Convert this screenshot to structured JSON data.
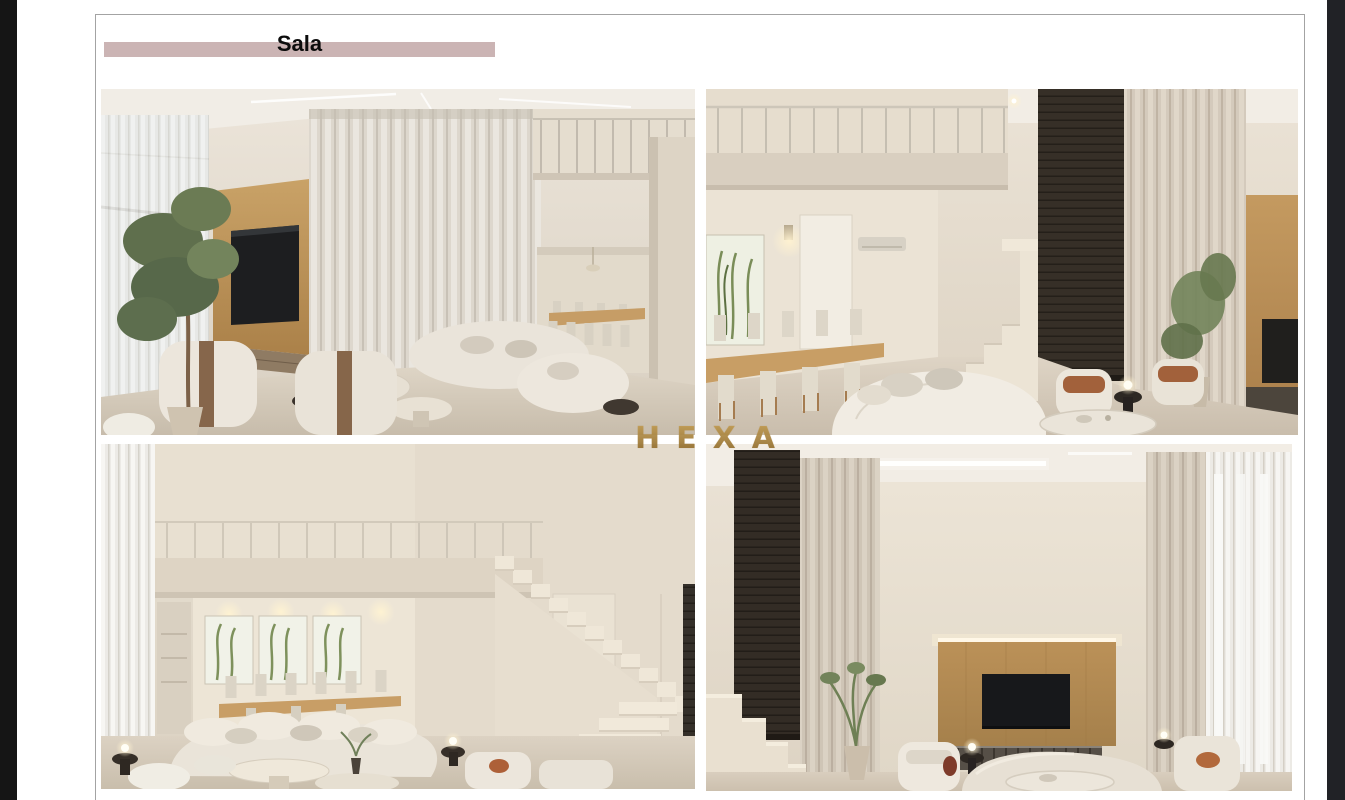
{
  "header": {
    "title": "Sala",
    "bar_color": "#cbb4b4"
  },
  "watermark": {
    "text": "HEXA",
    "color": "#b28a45"
  },
  "gallery": {
    "images": [
      {
        "id": "render-top-left",
        "alt": "Double-height living room render with tall sheer curtains, indoor tree, wood TV panel, beige armchairs and sofas, dining area under mezzanine"
      },
      {
        "id": "render-top-right",
        "alt": "Dining room render with long wood table and beige chairs, botanical artwork, staircase, dark slatted wall, tall curtains and curved white sofa"
      },
      {
        "id": "render-bottom-left",
        "alt": "Living room render with botanical triptych over dining nook, mezzanine bridge, stone staircase and long curved beige sofa with glowing lamps"
      },
      {
        "id": "render-bottom-right",
        "alt": "Lounge render with dark slatted panel, tall beige curtains, wood TV wall with LED strip, media console and curved sofa with armchairs"
      }
    ]
  }
}
